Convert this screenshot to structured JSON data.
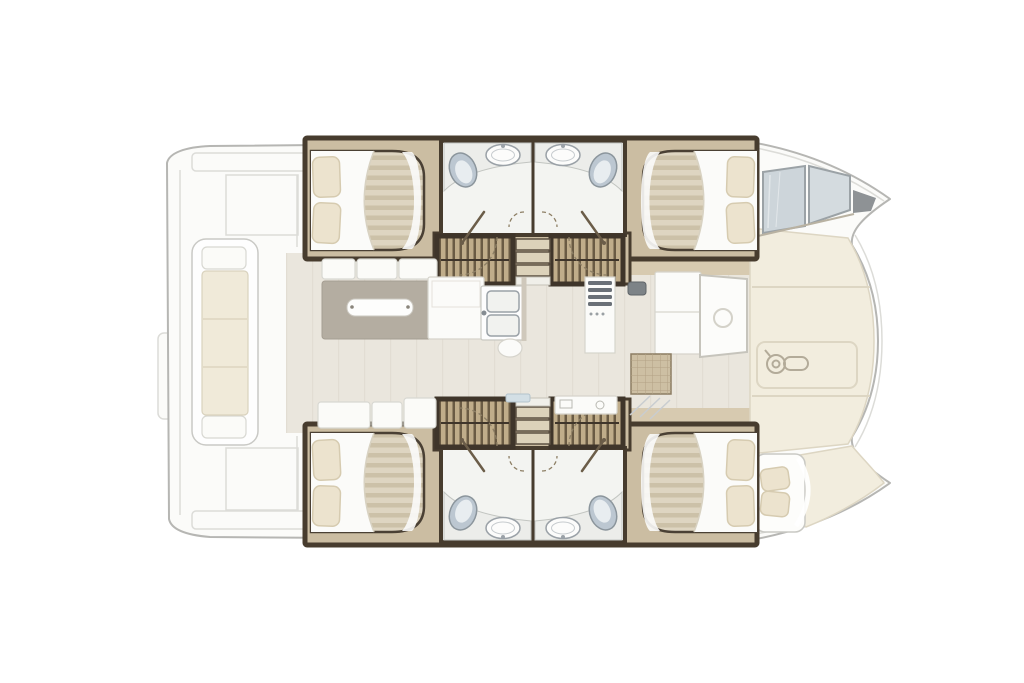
{
  "diagram": {
    "type": "catamaran-deck-floor-plan",
    "orientation": "bow-right",
    "areas": [
      "swim-platform",
      "cockpit-bench",
      "salon",
      "galley",
      "dinette-table",
      "port-aft-cabin",
      "port-forward-cabin",
      "port-bathrooms",
      "starboard-aft-cabin",
      "starboard-forward-cabin",
      "starboard-bathrooms",
      "companionway-stairs",
      "foredeck",
      "bow-skylight",
      "bow-berth"
    ],
    "icons": [
      "windlass-icon",
      "door-swing-icon",
      "sink-icon",
      "toilet-icon",
      "stove-icon"
    ]
  },
  "colors": {
    "background": "#ffffff",
    "hull_fill": "#fbfbf9",
    "hull_stroke": "#b6b6b3",
    "faint_line": "#dcdcd8",
    "deck_cream": "#f2edde",
    "deck_seam": "#ddd6c3",
    "salon_floor": "#eae6dd",
    "plank_line": "#e0dbd0",
    "wood_floor": "#cbbda2",
    "wood_walkway": "#d7cab0",
    "wall_dark": "#473c2e",
    "bathroom_floor": "#f3f4f1",
    "counter_fill": "#ecedea",
    "counter_stroke": "#c2c5c1",
    "sink_stroke": "#9aa1a7",
    "toilet_fill": "#bcc7d1",
    "toilet_stroke": "#8b959c",
    "mattress_light": "#ded5c1",
    "mattress_dark": "#ccc1a8",
    "duvet_white": "#fbfbf9",
    "bed_stroke": "#4a4034",
    "pillow_fill": "#ece3ce",
    "pillow_stroke": "#d6cbb0",
    "stair_frame": "#3f352a",
    "tread_light": "#c0ad8a",
    "tread_dark": "#6a5b44",
    "step_fill": "#dcd2ba",
    "step_stroke": "#5d5142",
    "door_arc": "#8d7f65",
    "door_leaf": "#6b5d49",
    "table_fill": "#b4ada1",
    "bench_fill": "#fbfbf8",
    "bench_stroke": "#d8d8d2",
    "glass_fill": "#cdd5da",
    "glass_stroke": "#9ba2a6",
    "tip_gray": "#8e9295",
    "cushion_fill": "#f0ead9",
    "stove_dark": "#6a7077",
    "hatch_fill": "#cdbfa3",
    "hatch_line": "#b2a284",
    "windlass_stroke": "#b3ab99",
    "appliance_gray": "#7d8387",
    "blue_accent": "#d3dfe5"
  }
}
